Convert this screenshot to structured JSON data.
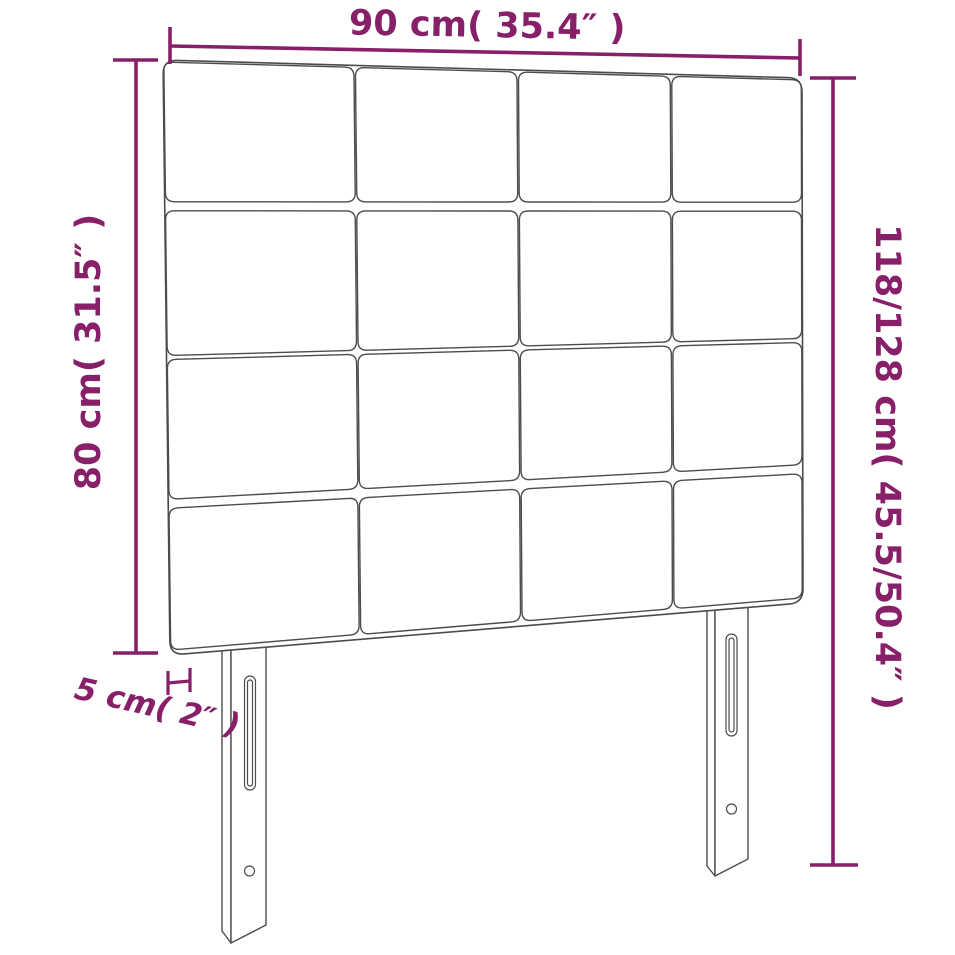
{
  "labels": {
    "width_top": "90 cm( 35.4″ )",
    "height_left": "80 cm( 31.5″ )",
    "height_right": "118/128 cm( 45.5/50.4″ )",
    "depth_bottom": "5 cm( 2″ )"
  },
  "colors": {
    "dimension_accent": "#872069",
    "drawing_outline": "#4c4c4c",
    "background": "#ffffff"
  }
}
